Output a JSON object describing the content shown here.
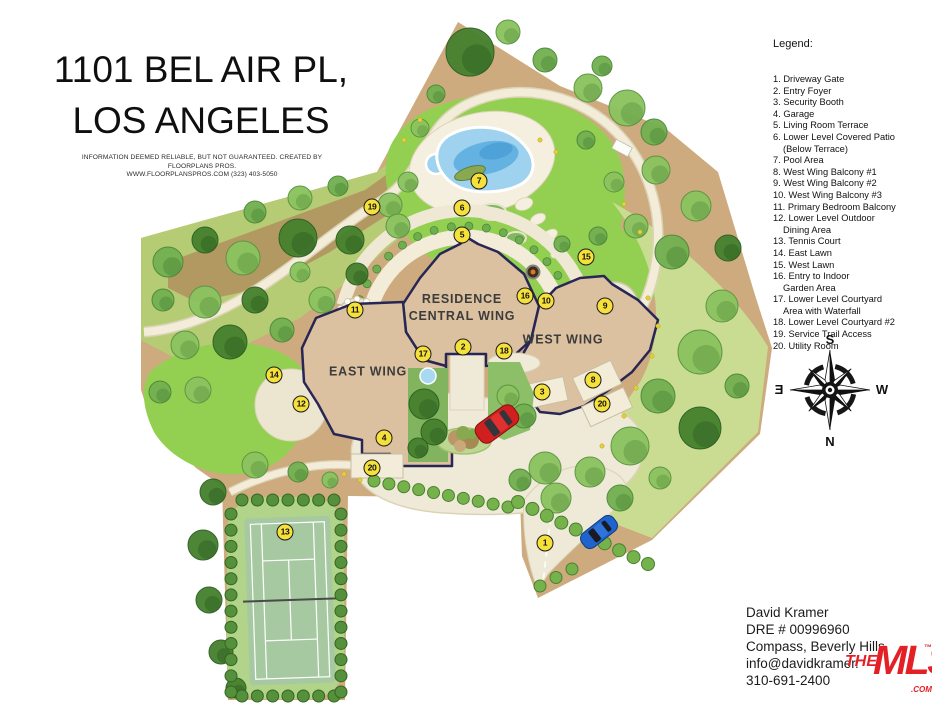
{
  "title": {
    "line1": "1101 BEL AIR PL,",
    "line2": "LOS ANGELES",
    "disclaimer_line1": "INFORMATION DEEMED RELIABLE, BUT NOT GUARANTEED. CREATED BY FLOORPLANS PROS.",
    "disclaimer_line2": "WWW.FLOORPLANSPROS.COM  (323) 403-5050"
  },
  "legend": {
    "heading": "Legend:",
    "items": [
      {
        "num": "1.",
        "label": "Driveway Gate"
      },
      {
        "num": "2.",
        "label": "Entry Foyer"
      },
      {
        "num": "3.",
        "label": "Security Booth"
      },
      {
        "num": "4.",
        "label": "Garage"
      },
      {
        "num": "5.",
        "label": "Living Room Terrace"
      },
      {
        "num": "6.",
        "label": "Lower Level Covered Patio",
        "label2": "(Below Terrace)"
      },
      {
        "num": "7.",
        "label": "Pool Area"
      },
      {
        "num": "8.",
        "label": "West Wing Balcony #1"
      },
      {
        "num": "9.",
        "label": "West Wing Balcony #2"
      },
      {
        "num": "10.",
        "label": "West Wing Balcony #3"
      },
      {
        "num": "11.",
        "label": "Primary Bedroom Balcony"
      },
      {
        "num": "12.",
        "label": "Lower Level Outdoor",
        "label2": "Dining Area"
      },
      {
        "num": "13.",
        "label": "Tennis Court"
      },
      {
        "num": "14.",
        "label": "East Lawn"
      },
      {
        "num": "15.",
        "label": "West Lawn"
      },
      {
        "num": "16.",
        "label": "Entry to Indoor",
        "label2": "Garden Area"
      },
      {
        "num": "17.",
        "label": "Lower Level Courtyard",
        "label2": "Area with Waterfall"
      },
      {
        "num": "18.",
        "label": "Lower Level Courtyard #2"
      },
      {
        "num": "19.",
        "label": "Service Trail Access"
      },
      {
        "num": "20.",
        "label": "Utility Room"
      }
    ]
  },
  "map": {
    "labels": {
      "residence": "RESIDENCE\nCENTRAL WING",
      "east_wing": "EAST WING",
      "west_wing": "WEST WING"
    },
    "label_positions": {
      "residence": {
        "x": 462,
        "y": 308
      },
      "east_wing": {
        "x": 368,
        "y": 372
      },
      "west_wing": {
        "x": 563,
        "y": 340
      }
    },
    "markers": [
      {
        "n": "1",
        "x": 545,
        "y": 543
      },
      {
        "n": "2",
        "x": 463,
        "y": 347
      },
      {
        "n": "3",
        "x": 542,
        "y": 392
      },
      {
        "n": "4",
        "x": 384,
        "y": 438
      },
      {
        "n": "5",
        "x": 462,
        "y": 235
      },
      {
        "n": "6",
        "x": 462,
        "y": 208
      },
      {
        "n": "7",
        "x": 479,
        "y": 181
      },
      {
        "n": "8",
        "x": 593,
        "y": 380
      },
      {
        "n": "9",
        "x": 605,
        "y": 306
      },
      {
        "n": "10",
        "x": 546,
        "y": 301
      },
      {
        "n": "11",
        "x": 355,
        "y": 310
      },
      {
        "n": "12",
        "x": 301,
        "y": 404
      },
      {
        "n": "13",
        "x": 285,
        "y": 532
      },
      {
        "n": "14",
        "x": 274,
        "y": 375
      },
      {
        "n": "15",
        "x": 586,
        "y": 257
      },
      {
        "n": "16",
        "x": 525,
        "y": 296
      },
      {
        "n": "17",
        "x": 423,
        "y": 354
      },
      {
        "n": "18",
        "x": 504,
        "y": 351
      },
      {
        "n": "19",
        "x": 372,
        "y": 207
      },
      {
        "n": "20",
        "x": 602,
        "y": 404
      },
      {
        "n": "20",
        "x": 372,
        "y": 468
      }
    ],
    "compass": {
      "north": "N",
      "south": "S",
      "east": "E",
      "west": "W"
    }
  },
  "agent": {
    "name": "David Kramer",
    "dre": "DRE # 00996960",
    "brokerage": "Compass, Beverly Hills",
    "email": "info@davidkramer.",
    "phone": "310-691-2400"
  },
  "logo": {
    "the": "THE",
    "mls": "MLS",
    "tm": "™",
    "com": ".COM"
  },
  "colors": {
    "marker_yellow": "#f6e13b",
    "building_tan": "#dcc1a1",
    "outline_navy": "#272655",
    "lawn_green": "#93d051",
    "pool_blue": "#9ed2ee",
    "mls_red": "#e41f26"
  }
}
